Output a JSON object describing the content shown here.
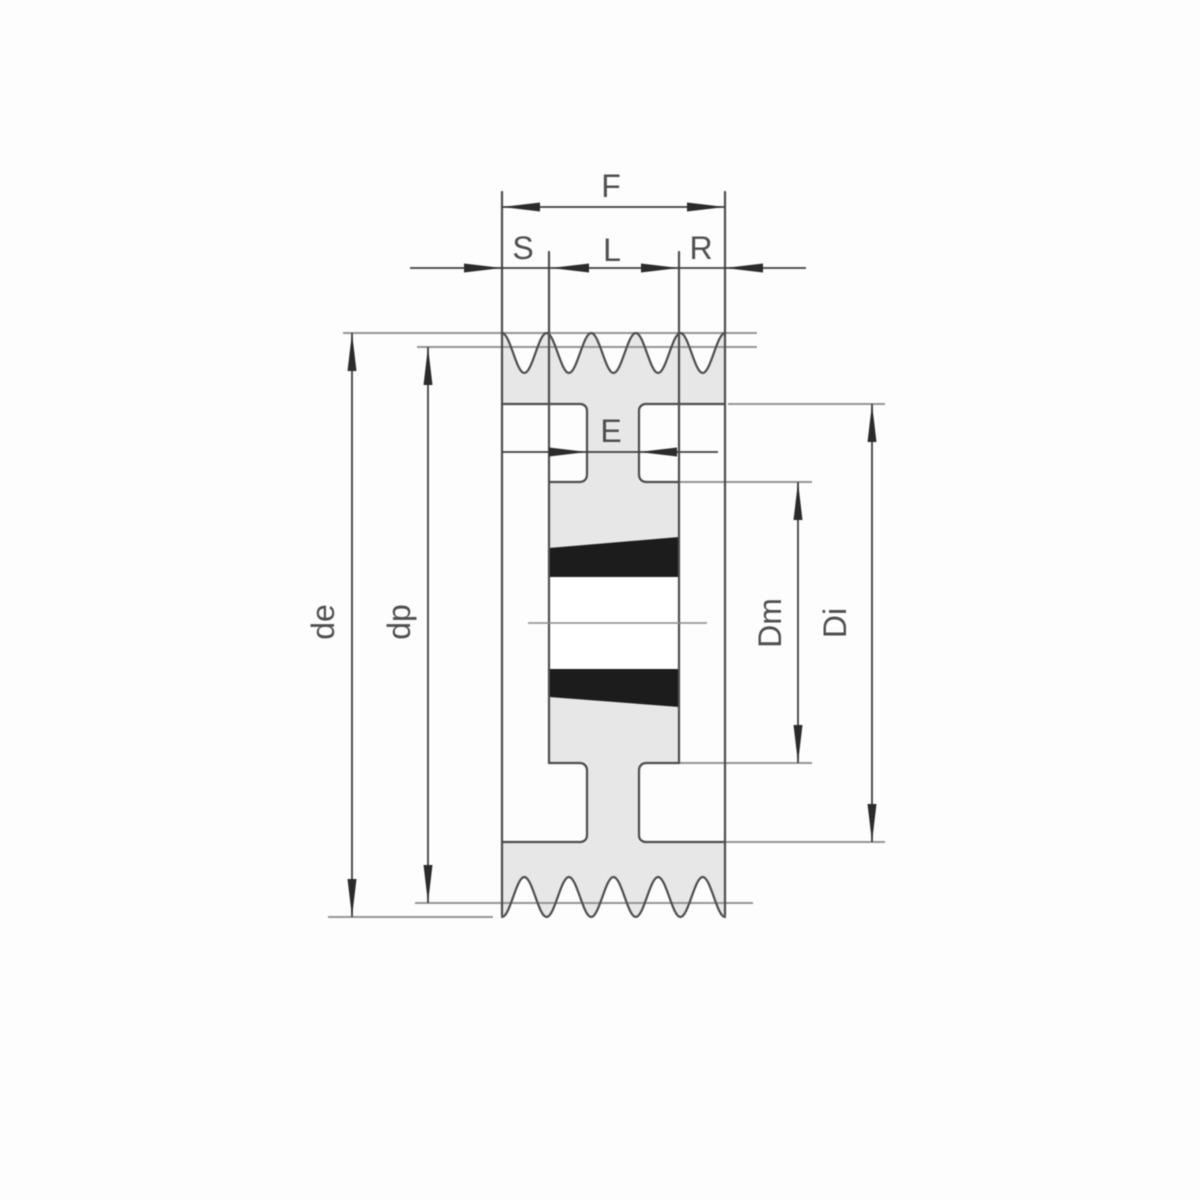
{
  "drawing_labels": {
    "F": "F",
    "S": "S",
    "L": "L",
    "R": "R",
    "E": "E",
    "de": "de",
    "dp": "dp",
    "Dm": "Dm",
    "Di": "Di"
  },
  "colors": {
    "background": "#fdfdfd",
    "part_fill": "#e7e7e7",
    "bore_fill": "#ffffff",
    "bush_section_fill": "#1c1c1c",
    "outline": "#4d4d4d",
    "reference_line": "#969696",
    "dimension_line": "#3f3f3f",
    "arrowhead": "#2b2b2b",
    "center_line": "#8a8a8a",
    "label_text": "#4f4f4f"
  }
}
